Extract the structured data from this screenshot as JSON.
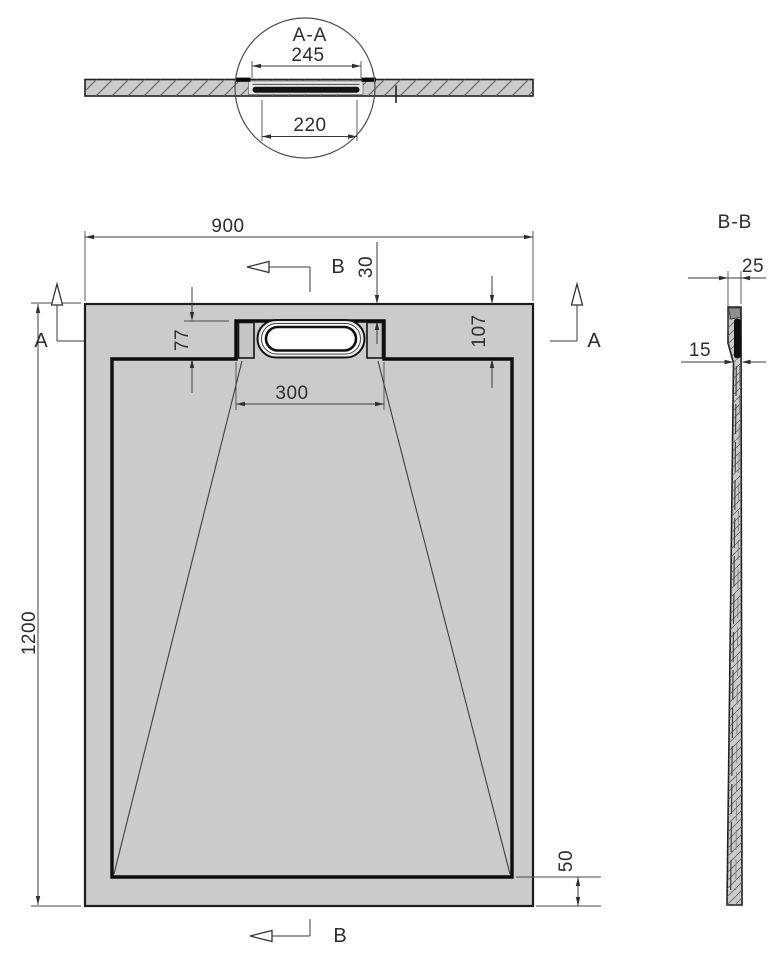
{
  "colors": {
    "tray_fill": "#cbcbcb",
    "recess_fill": "#e6e6e6",
    "line": "#1f1f1f",
    "dim_line": "#3c3c3c",
    "drain_black": "#111111",
    "background": "#ffffff"
  },
  "detail_aa": {
    "title": "A-A",
    "dim_flange_width": "245",
    "dim_channel_width": "220"
  },
  "plan_view": {
    "dim_width": "900",
    "dim_length": "1200",
    "dim_channel_depth": "77",
    "dim_top_inset": "107",
    "dim_edge_to_channel": "30",
    "dim_channel_width": "300",
    "dim_bottom_inset": "50",
    "section_a_label": "A",
    "section_b_label": "B"
  },
  "section_bb": {
    "title": "B-B",
    "dim_top_thickness": "25",
    "dim_body_thickness": "15"
  }
}
